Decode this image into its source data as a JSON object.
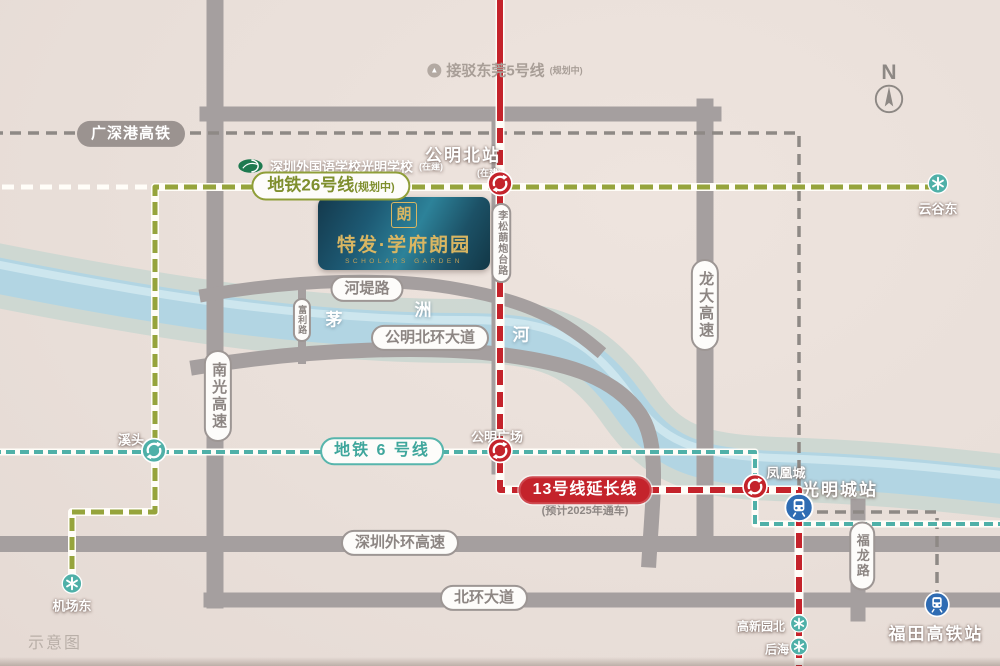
{
  "map": {
    "note": "示意图",
    "compass_label": "N"
  },
  "project": {
    "logo_mark": "朗",
    "name": "特发·学府朗园",
    "name_en": "SCHOLARS GARDEN"
  },
  "landmarks": {
    "dongguan_link": {
      "label": "接驳东莞5号线",
      "status": "(规划中)"
    },
    "school": {
      "label": "深圳外国语学校光明学校",
      "status": "(在建)"
    }
  },
  "rail": {
    "gsg_hsr": "广深港高铁",
    "line26": {
      "label": "地铁26号线",
      "status": "(规划中)"
    },
    "line6": {
      "label": "地铁 6 号线"
    },
    "line13": {
      "label": "13号线延长线",
      "status": "(预计2025年通车)"
    }
  },
  "roads": {
    "hedi": "河堤路",
    "fuli": "富利路",
    "lisonglang": "李松蓢炮台路",
    "nanguang": "南光高速",
    "longda": "龙大高速",
    "gongming_ring": "公明北环大道",
    "outer_ring": "深圳外环高速",
    "beihuan": "北环大道",
    "fulong": "福龙路"
  },
  "river": {
    "char1": "茅",
    "char2": "洲",
    "char3": "河"
  },
  "stations": {
    "gongmingbei": {
      "name": "公明北站",
      "status": "(在建)"
    },
    "yungudong": "云谷东",
    "xitou": "溪头",
    "gongming_square": "公明广场",
    "fenghuangcheng": "凤凰城",
    "guangmingcheng": "光明城站",
    "jichangdong": "机场东",
    "gaoxinyuanbei": "高新园北",
    "houhai": "后海",
    "futian": "福田高铁站"
  },
  "colors": {
    "background": "#e9dfd9",
    "road_gray": "#a59f9f",
    "river_blue": "#b2d5e3",
    "line26_olive": "#96a43c",
    "line6_teal": "#4fb0a8",
    "line13_red": "#c4232b",
    "hsr_gray": "#8e8985",
    "hsr_station_blue": "#2f6cb3",
    "brand_gold": "#d9b662",
    "logo_teal": "#1d5a74"
  }
}
